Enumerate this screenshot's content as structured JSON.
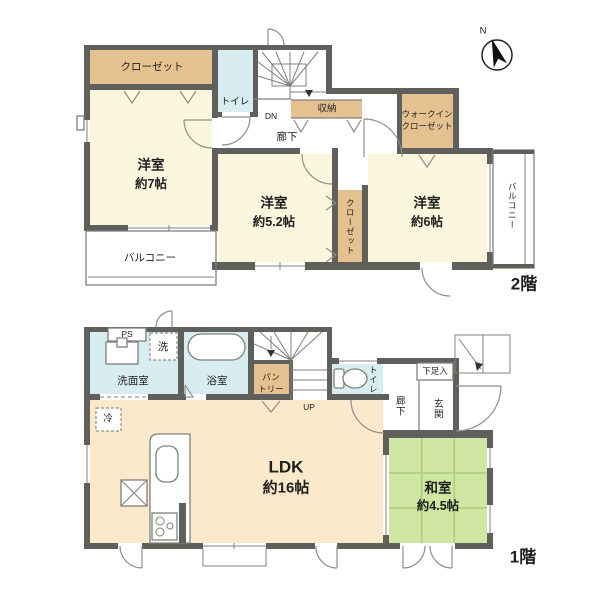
{
  "colors": {
    "wall": "#5f5f5c",
    "line": "#80807a",
    "text": "#1e1e1e",
    "room_cream": "#fbf7df",
    "room_peach": "#fbe9cb",
    "room_tan": "#e5c190",
    "room_blue": "#d7edf1",
    "room_green": "#cfe7a2",
    "tatami_line": "#aacb7d"
  },
  "floor2": {
    "floor_label": "2階",
    "compass_n": "N",
    "closet_top": "クローゼット",
    "yoshitsu7_name": "洋室",
    "yoshitsu7_size": "約7帖",
    "toilet": "トイレ",
    "stairs_dn": "DN",
    "storage": "収納",
    "hallway": "廊下",
    "wic_line1": "ウォークイン",
    "wic_line2": "クローゼット",
    "yoshitsu52_name": "洋室",
    "yoshitsu52_size": "約5.2帖",
    "closet_mid": "クローゼット",
    "yoshitsu6_name": "洋室",
    "yoshitsu6_size": "約6帖",
    "balcony_left": "バルコニー",
    "balcony_right": "バルコニー"
  },
  "floor1": {
    "floor_label": "1階",
    "ps": "PS",
    "laundry": "洗",
    "senmen": "洗面室",
    "bath": "浴室",
    "pantry_line1": "パン",
    "pantry_line2": "トリー",
    "stairs_up": "UP",
    "toilet": "トイレ",
    "hallway": "廊下",
    "shoe_box": "下足入",
    "genkan": "玄関",
    "fridge": "冷",
    "ldk_name": "LDK",
    "ldk_size": "約16帖",
    "washitsu_name": "和室",
    "washitsu_size": "約4.5帖"
  }
}
